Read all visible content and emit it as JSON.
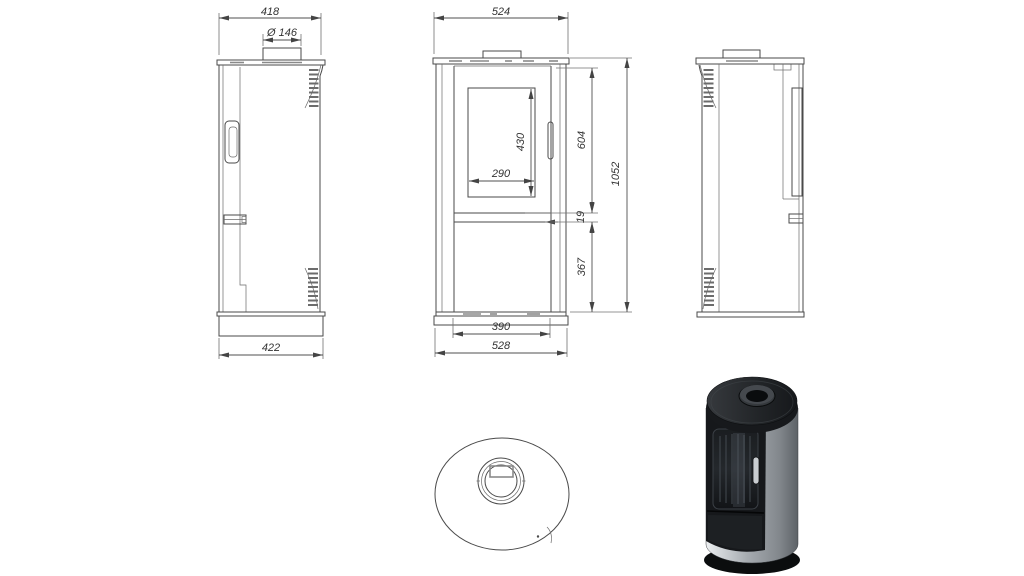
{
  "sheet": {
    "title": "Oval stove technical drawing"
  },
  "left_view": {
    "top_width": "418",
    "flue_diameter": "Ø 146",
    "base_width": "422"
  },
  "front_view": {
    "top_width": "524",
    "glass_width": "290",
    "glass_height": "430",
    "upper_height": "604",
    "ember_strip": "19",
    "total_height": "1052",
    "lower_height": "367",
    "inner_base_width": "390",
    "base_width": "528"
  },
  "colors": {
    "line": "#4a4a4a",
    "dim_text": "#333333",
    "steel_light": "#eef0f2",
    "steel_dark": "#62676c",
    "body_black": "#16181b",
    "background": "#ffffff"
  }
}
